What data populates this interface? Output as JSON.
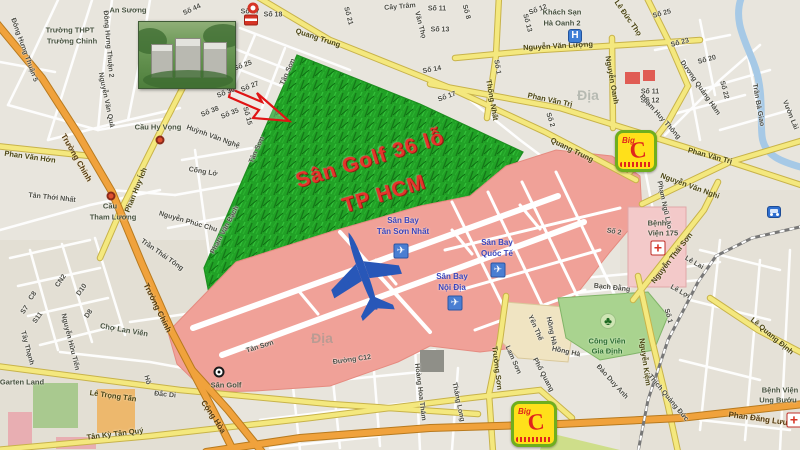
{
  "map": {
    "colors": {
      "golf_green": "#21a126",
      "airport_pink": "#f0a198",
      "road_yellow": "#f4e87e",
      "road_orange": "#f0a23c",
      "airport_label_blue": "#3a46bd",
      "golf_title_red": "#e5342b",
      "water_blue": "#a6c9e6",
      "park_green": "#a9d38f"
    },
    "labels": [
      {
        "t": "An Sương",
        "x": 128,
        "y": 10,
        "r": 0,
        "c": "poi"
      },
      {
        "t": "Trường THPT",
        "x": 70,
        "y": 30,
        "r": 0,
        "c": "poi"
      },
      {
        "t": "Trường Chinh",
        "x": 72,
        "y": 41,
        "r": 0,
        "c": "poi"
      },
      {
        "t": "Đông Hưng Thuận 2",
        "x": 108,
        "y": 44,
        "r": 85,
        "c": "s"
      },
      {
        "t": "Đông Hưng Thuận 5",
        "x": 24,
        "y": 50,
        "r": 70,
        "c": "s"
      },
      {
        "t": "Nguyễn Văn Quá",
        "x": 106,
        "y": 100,
        "r": 78,
        "c": "s"
      },
      {
        "t": "Số 44",
        "x": 192,
        "y": 10,
        "r": -25,
        "c": "s"
      },
      {
        "t": "Số 17",
        "x": 250,
        "y": 12,
        "r": 0,
        "c": "s"
      },
      {
        "t": "Số 18",
        "x": 273,
        "y": 15,
        "r": 0,
        "c": "s"
      },
      {
        "t": "Số 21",
        "x": 348,
        "y": 16,
        "r": 75,
        "c": "s"
      },
      {
        "t": "Cây Trâm",
        "x": 400,
        "y": 7,
        "r": -5,
        "c": "s"
      },
      {
        "t": "Văn Thọ",
        "x": 420,
        "y": 25,
        "r": 75,
        "c": "s"
      },
      {
        "t": "Số 11",
        "x": 437,
        "y": 9,
        "r": 0,
        "c": "s"
      },
      {
        "t": "Số 13",
        "x": 440,
        "y": 30,
        "r": 0,
        "c": "s"
      },
      {
        "t": "Số 8",
        "x": 466,
        "y": 12,
        "r": 75,
        "c": "s"
      },
      {
        "t": "Số 12",
        "x": 538,
        "y": 10,
        "r": -20,
        "c": "s"
      },
      {
        "t": "Số 13",
        "x": 527,
        "y": 23,
        "r": 75,
        "c": "s"
      },
      {
        "t": "Khách Sạn",
        "x": 562,
        "y": 12,
        "r": 0,
        "c": "poi"
      },
      {
        "t": "Hà Oanh 2",
        "x": 562,
        "y": 23,
        "r": 0,
        "c": "poi"
      },
      {
        "t": "Lê Đức Thọ",
        "x": 628,
        "y": 18,
        "r": 55,
        "c": "sr"
      },
      {
        "t": "Số 25",
        "x": 662,
        "y": 14,
        "r": -15,
        "c": "s"
      },
      {
        "t": "Số 23",
        "x": 680,
        "y": 43,
        "r": -15,
        "c": "s"
      },
      {
        "t": "Số 20",
        "x": 707,
        "y": 60,
        "r": -15,
        "c": "s"
      },
      {
        "t": "Số 22",
        "x": 724,
        "y": 90,
        "r": 75,
        "c": "s"
      },
      {
        "t": "Quang Trung",
        "x": 318,
        "y": 38,
        "r": 18,
        "c": "sr"
      },
      {
        "t": "Quang Trung",
        "x": 572,
        "y": 150,
        "r": 26,
        "c": "sr"
      },
      {
        "t": "Nguyễn Văn Lượng",
        "x": 558,
        "y": 46,
        "r": -3,
        "c": "sr"
      },
      {
        "t": "Phan Văn Trị",
        "x": 550,
        "y": 100,
        "r": 12,
        "c": "sr"
      },
      {
        "t": "Phan Văn Trị",
        "x": 710,
        "y": 156,
        "r": 15,
        "c": "sr"
      },
      {
        "t": "Thống Nhất",
        "x": 492,
        "y": 100,
        "r": 80,
        "c": "sr"
      },
      {
        "t": "Số 1",
        "x": 497,
        "y": 67,
        "r": 80,
        "c": "s"
      },
      {
        "t": "Số 14",
        "x": 432,
        "y": 70,
        "r": -10,
        "c": "s"
      },
      {
        "t": "Số 17",
        "x": 447,
        "y": 97,
        "r": -20,
        "c": "s"
      },
      {
        "t": "Nguyễn Oanh",
        "x": 612,
        "y": 80,
        "r": 80,
        "c": "sr"
      },
      {
        "t": "Số 11",
        "x": 650,
        "y": 92,
        "r": 0,
        "c": "s"
      },
      {
        "t": "Số 12",
        "x": 650,
        "y": 101,
        "r": 0,
        "c": "s"
      },
      {
        "t": "Dương Quảng Hàm",
        "x": 700,
        "y": 88,
        "r": 55,
        "c": "s"
      },
      {
        "t": "Phạm Huy Thông",
        "x": 660,
        "y": 117,
        "r": 48,
        "c": "s"
      },
      {
        "t": "Trần Bá Giao",
        "x": 758,
        "y": 105,
        "r": 80,
        "c": "s"
      },
      {
        "t": "Vườn Lài",
        "x": 790,
        "y": 115,
        "r": 68,
        "c": "s"
      },
      {
        "t": "Số 25",
        "x": 243,
        "y": 66,
        "r": -20,
        "c": "s"
      },
      {
        "t": "Số 27",
        "x": 250,
        "y": 87,
        "r": -22,
        "c": "s"
      },
      {
        "t": "Số 30",
        "x": 226,
        "y": 93,
        "r": -22,
        "c": "s"
      },
      {
        "t": "Số 38",
        "x": 210,
        "y": 112,
        "r": -22,
        "c": "s"
      },
      {
        "t": "Số 35",
        "x": 230,
        "y": 114,
        "r": -22,
        "c": "s"
      },
      {
        "t": "Số 15",
        "x": 247,
        "y": 116,
        "r": 75,
        "c": "s"
      },
      {
        "t": "Tân Sơn",
        "x": 288,
        "y": 72,
        "r": -66,
        "c": "s"
      },
      {
        "t": "Tân Sơn",
        "x": 257,
        "y": 150,
        "r": -66,
        "c": "s"
      },
      {
        "t": "Huỳnh Văn Nghệ",
        "x": 213,
        "y": 137,
        "r": 20,
        "c": "s"
      },
      {
        "t": "Cống Lở",
        "x": 203,
        "y": 172,
        "r": 10,
        "c": "s"
      },
      {
        "t": "Nguyễn Phúc Chu",
        "x": 188,
        "y": 222,
        "r": 16,
        "c": "s"
      },
      {
        "t": "Phạm Văn Bạch",
        "x": 225,
        "y": 230,
        "r": -62,
        "c": "s"
      },
      {
        "t": "Cầu Hy Vọng",
        "x": 158,
        "y": 127,
        "r": 0,
        "c": "poi"
      },
      {
        "t": "Phan Huy Ích",
        "x": 136,
        "y": 190,
        "r": -68,
        "c": "sr"
      },
      {
        "t": "Phan Văn Hớn",
        "x": 30,
        "y": 157,
        "r": 8,
        "c": "sr"
      },
      {
        "t": "Trường Chinh",
        "x": 76,
        "y": 158,
        "r": 60,
        "c": "or"
      },
      {
        "t": "Tân Thới Nhất",
        "x": 52,
        "y": 198,
        "r": 6,
        "c": "s"
      },
      {
        "t": "Cầu",
        "x": 110,
        "y": 206,
        "r": 0,
        "c": "poi"
      },
      {
        "t": "Tham Lương",
        "x": 113,
        "y": 217,
        "r": 0,
        "c": "poi"
      },
      {
        "t": "Trần Thái Tông",
        "x": 162,
        "y": 255,
        "r": 35,
        "c": "s"
      },
      {
        "t": "Trường Chinh",
        "x": 157,
        "y": 308,
        "r": 64,
        "c": "or"
      },
      {
        "t": "Tây Thạnh",
        "x": 27,
        "y": 348,
        "r": 75,
        "c": "s"
      },
      {
        "t": "CN2",
        "x": 61,
        "y": 281,
        "r": -55,
        "c": "s"
      },
      {
        "t": "D10",
        "x": 82,
        "y": 290,
        "r": -55,
        "c": "s"
      },
      {
        "t": "C8",
        "x": 33,
        "y": 296,
        "r": -55,
        "c": "s"
      },
      {
        "t": "S7",
        "x": 25,
        "y": 310,
        "r": -55,
        "c": "s"
      },
      {
        "t": "S11",
        "x": 38,
        "y": 318,
        "r": -55,
        "c": "s"
      },
      {
        "t": "D8",
        "x": 89,
        "y": 314,
        "r": -55,
        "c": "s"
      },
      {
        "t": "Chợ Lan Viên",
        "x": 124,
        "y": 330,
        "r": 10,
        "c": "poi"
      },
      {
        "t": "Nguyễn Hữu Tiến",
        "x": 70,
        "y": 342,
        "r": 76,
        "c": "s"
      },
      {
        "t": "Garten Land",
        "x": 22,
        "y": 382,
        "r": 0,
        "c": "poi"
      },
      {
        "t": "Lê Trọng Tấn",
        "x": 113,
        "y": 396,
        "r": 8,
        "c": "sr"
      },
      {
        "t": "Hồ",
        "x": 147,
        "y": 380,
        "r": 75,
        "c": "s"
      },
      {
        "t": "Đắc Di",
        "x": 165,
        "y": 395,
        "r": 6,
        "c": "s"
      },
      {
        "t": "Tân Kỳ Tân Quý",
        "x": 115,
        "y": 434,
        "r": -7,
        "c": "sr"
      },
      {
        "t": "Cộng Hòa",
        "x": 213,
        "y": 417,
        "r": 56,
        "c": "or"
      },
      {
        "t": "Sân Golf 36 lỗ",
        "x": 370,
        "y": 159,
        "r": -17,
        "c": "golf"
      },
      {
        "t": "TP HCM",
        "x": 384,
        "y": 194,
        "r": -17,
        "c": "golf"
      },
      {
        "t": "Sân Bay",
        "x": 403,
        "y": 221,
        "r": 0,
        "c": "blue"
      },
      {
        "t": "Tân Sơn Nhất",
        "x": 403,
        "y": 232,
        "r": 0,
        "c": "blue"
      },
      {
        "t": "Sân Bay",
        "x": 497,
        "y": 243,
        "r": 0,
        "c": "blue"
      },
      {
        "t": "Quốc Tế",
        "x": 497,
        "y": 254,
        "r": 0,
        "c": "blue"
      },
      {
        "t": "Sân Bay",
        "x": 452,
        "y": 277,
        "r": 0,
        "c": "blue"
      },
      {
        "t": "Nội Địa",
        "x": 452,
        "y": 288,
        "r": 0,
        "c": "blue"
      },
      {
        "t": "Sân Golf",
        "x": 226,
        "y": 385,
        "r": 0,
        "c": "poi"
      },
      {
        "t": "Tân Sơn",
        "x": 260,
        "y": 347,
        "r": -17,
        "c": "s"
      },
      {
        "t": "Đường C12",
        "x": 352,
        "y": 360,
        "r": -8,
        "c": "s"
      },
      {
        "t": "Hoàng Hoa Thám",
        "x": 420,
        "y": 392,
        "r": 83,
        "c": "s"
      },
      {
        "t": "Trường Sơn",
        "x": 497,
        "y": 368,
        "r": 83,
        "c": "sr"
      },
      {
        "t": "Thăng Long",
        "x": 458,
        "y": 402,
        "r": 78,
        "c": "s"
      },
      {
        "t": "Lam Sơn",
        "x": 513,
        "y": 360,
        "r": 66,
        "c": "s"
      },
      {
        "t": "Yên Thế",
        "x": 535,
        "y": 328,
        "r": 66,
        "c": "s"
      },
      {
        "t": "Hồng Hà",
        "x": 551,
        "y": 331,
        "r": 78,
        "c": "s"
      },
      {
        "t": "Hồng Hà",
        "x": 566,
        "y": 352,
        "r": 12,
        "c": "s"
      },
      {
        "t": "Phổ Quang",
        "x": 543,
        "y": 375,
        "r": 62,
        "c": "s"
      },
      {
        "t": "Bạch Đằng",
        "x": 612,
        "y": 288,
        "r": 6,
        "c": "s"
      },
      {
        "t": "Công Viên",
        "x": 607,
        "y": 341,
        "r": 0,
        "c": "park"
      },
      {
        "t": "Gia Định",
        "x": 607,
        "y": 351,
        "r": 0,
        "c": "park"
      },
      {
        "t": "Đào Duy Anh",
        "x": 612,
        "y": 382,
        "r": 48,
        "c": "s"
      },
      {
        "t": "Nguyễn Kiệm",
        "x": 645,
        "y": 362,
        "r": 82,
        "c": "sr"
      },
      {
        "t": "Thích Quảng Đức",
        "x": 668,
        "y": 398,
        "r": 50,
        "c": "s"
      },
      {
        "t": "Lê Quang Định",
        "x": 772,
        "y": 336,
        "r": 40,
        "c": "sr"
      },
      {
        "t": "Bệnh Viện",
        "x": 780,
        "y": 390,
        "r": 0,
        "c": "poi"
      },
      {
        "t": "Ung Bướu",
        "x": 778,
        "y": 400,
        "r": 0,
        "c": "poi"
      },
      {
        "t": "Phan Đăng Lưu",
        "x": 758,
        "y": 419,
        "r": 8,
        "c": "or"
      },
      {
        "t": "Lê Lợi",
        "x": 680,
        "y": 292,
        "r": 30,
        "c": "s"
      },
      {
        "t": "Lê Lai",
        "x": 694,
        "y": 263,
        "r": 30,
        "c": "s"
      },
      {
        "t": "Số 1",
        "x": 668,
        "y": 316,
        "r": 75,
        "c": "s"
      },
      {
        "t": "Nguyễn Thái Sơn",
        "x": 672,
        "y": 258,
        "r": -52,
        "c": "sr"
      },
      {
        "t": "Phạm Ngũ Lão",
        "x": 664,
        "y": 205,
        "r": 78,
        "c": "s"
      },
      {
        "t": "Nguyễn Văn Nghi",
        "x": 690,
        "y": 186,
        "r": 20,
        "c": "sr"
      },
      {
        "t": "Số 2",
        "x": 550,
        "y": 120,
        "r": 72,
        "c": "s"
      },
      {
        "t": "Số 2",
        "x": 614,
        "y": 232,
        "r": 10,
        "c": "s"
      },
      {
        "t": "Bệnh",
        "x": 657,
        "y": 223,
        "r": 0,
        "c": "poi"
      },
      {
        "t": "Viện 175",
        "x": 663,
        "y": 233,
        "r": 0,
        "c": "poi"
      },
      {
        "t": "Địa",
        "x": 322,
        "y": 338,
        "r": 0,
        "c": "wm"
      },
      {
        "t": "Địa",
        "x": 588,
        "y": 95,
        "r": 0,
        "c": "wm"
      }
    ],
    "icons": [
      {
        "type": "circle-red",
        "x": 253,
        "y": 8
      },
      {
        "type": "shrine",
        "x": 251,
        "y": 20
      },
      {
        "type": "bridge-dot",
        "x": 160,
        "y": 140
      },
      {
        "type": "bridge-dot",
        "x": 111,
        "y": 196
      },
      {
        "type": "hotel",
        "x": 575,
        "y": 36,
        "glyph": "H"
      },
      {
        "type": "hospital",
        "x": 658,
        "y": 248,
        "glyph": "+"
      },
      {
        "type": "hospital",
        "x": 794,
        "y": 420,
        "glyph": "+"
      },
      {
        "type": "bus",
        "x": 774,
        "y": 212
      },
      {
        "type": "airport",
        "x": 401,
        "y": 251,
        "glyph": "✈"
      },
      {
        "type": "airport",
        "x": 498,
        "y": 270,
        "glyph": "✈"
      },
      {
        "type": "airport",
        "x": 455,
        "y": 303,
        "glyph": "✈"
      },
      {
        "type": "bigc",
        "x": 636,
        "y": 151,
        "size": 42,
        "label_small": "Big",
        "label": "C"
      },
      {
        "type": "bigc",
        "x": 534,
        "y": 424,
        "size": 46,
        "label_small": "Big",
        "label": "C"
      },
      {
        "type": "tree",
        "x": 608,
        "y": 321,
        "glyph": "♣"
      },
      {
        "type": "golf-marker",
        "x": 219,
        "y": 372
      }
    ]
  }
}
